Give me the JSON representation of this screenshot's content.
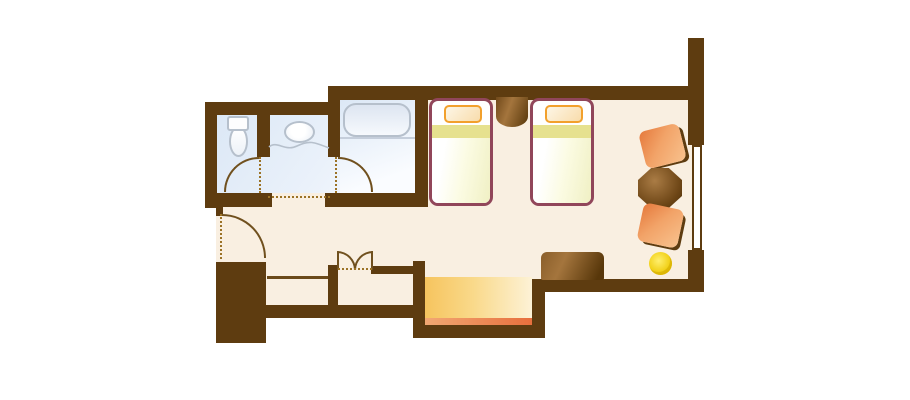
{
  "title": "hotel-twin-room-floor-plan",
  "palette": {
    "wall": "#5e3c10",
    "floor": "#f9efe1",
    "bath_floor_a": "#dce8f6",
    "bath_floor_b": "#fafcff",
    "fixture_border": "#b6c0cc",
    "tub_a": "#dde5f1",
    "tub_b": "#f6f9fd",
    "door_arc": "#70501e",
    "dotted": "#9b7226",
    "bed_border": "#91465a",
    "pillow_border": "#f2a02c",
    "pillow_fill_a": "#fdf6e6",
    "pillow_fill_b": "#f8dcab",
    "blanket_band": "#e6e18f",
    "bed_body_a": "#ffffff",
    "bed_body_b": "#f0f0c4",
    "wood_a": "#a4753d",
    "wood_b": "#58370a",
    "table_a": "#aa7c45",
    "table_b": "#4d2e06",
    "chair_a": "#e5793c",
    "chair_b": "#f8c28e",
    "lamp_a": "#ffef6e",
    "lamp_b": "#eec903",
    "genkan_a": "#f6c45e",
    "genkan_b": "#fdf2d6",
    "genkan_strip_a": "#f2a873",
    "genkan_strip_b": "#e76f3d"
  },
  "rooms": [
    {
      "name": "toilet-room"
    },
    {
      "name": "washbasin-room"
    },
    {
      "name": "bathroom"
    },
    {
      "name": "bedroom"
    },
    {
      "name": "closet"
    },
    {
      "name": "luggage-alcove"
    },
    {
      "name": "entrance-genkan"
    }
  ],
  "furniture": [
    {
      "name": "toilet"
    },
    {
      "name": "washbasin"
    },
    {
      "name": "bathtub"
    },
    {
      "name": "twin-bed-1"
    },
    {
      "name": "twin-bed-2"
    },
    {
      "name": "nightstand"
    },
    {
      "name": "armchair-1"
    },
    {
      "name": "tea-table"
    },
    {
      "name": "armchair-2"
    },
    {
      "name": "floor-lamp"
    },
    {
      "name": "tv-board"
    },
    {
      "name": "window"
    }
  ],
  "doors": [
    {
      "name": "toilet-door-swing"
    },
    {
      "name": "washroom-open-doorway"
    },
    {
      "name": "bathroom-door-swing"
    },
    {
      "name": "room-entry-door-swing"
    },
    {
      "name": "closet-bifold-doors"
    }
  ]
}
